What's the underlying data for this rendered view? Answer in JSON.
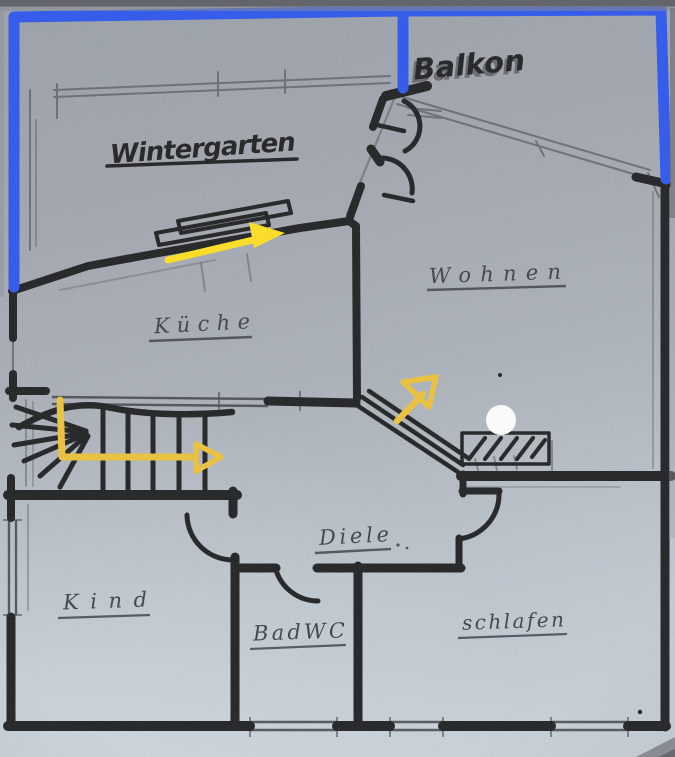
{
  "plan": {
    "rooms": [
      {
        "key": "wintergarten",
        "label": "Wintergarten"
      },
      {
        "key": "balkon",
        "label": "Balkon"
      },
      {
        "key": "wohnen",
        "label": "Wohnen"
      },
      {
        "key": "kueche",
        "label": "Küche"
      },
      {
        "key": "diele",
        "label": "Diele"
      },
      {
        "key": "kind",
        "label": "Kind"
      },
      {
        "key": "badwc",
        "label": "BadWC"
      },
      {
        "key": "schlafen",
        "label": "schlafen"
      }
    ]
  },
  "colors": {
    "highlight_blue": "#2b55ee",
    "arrow_yellow": "#ffe01f",
    "arrow_gold": "#edc238",
    "marker_ink": "#1d1e20",
    "pencil": "#3c3f45",
    "white_dot": "#ffffff"
  }
}
